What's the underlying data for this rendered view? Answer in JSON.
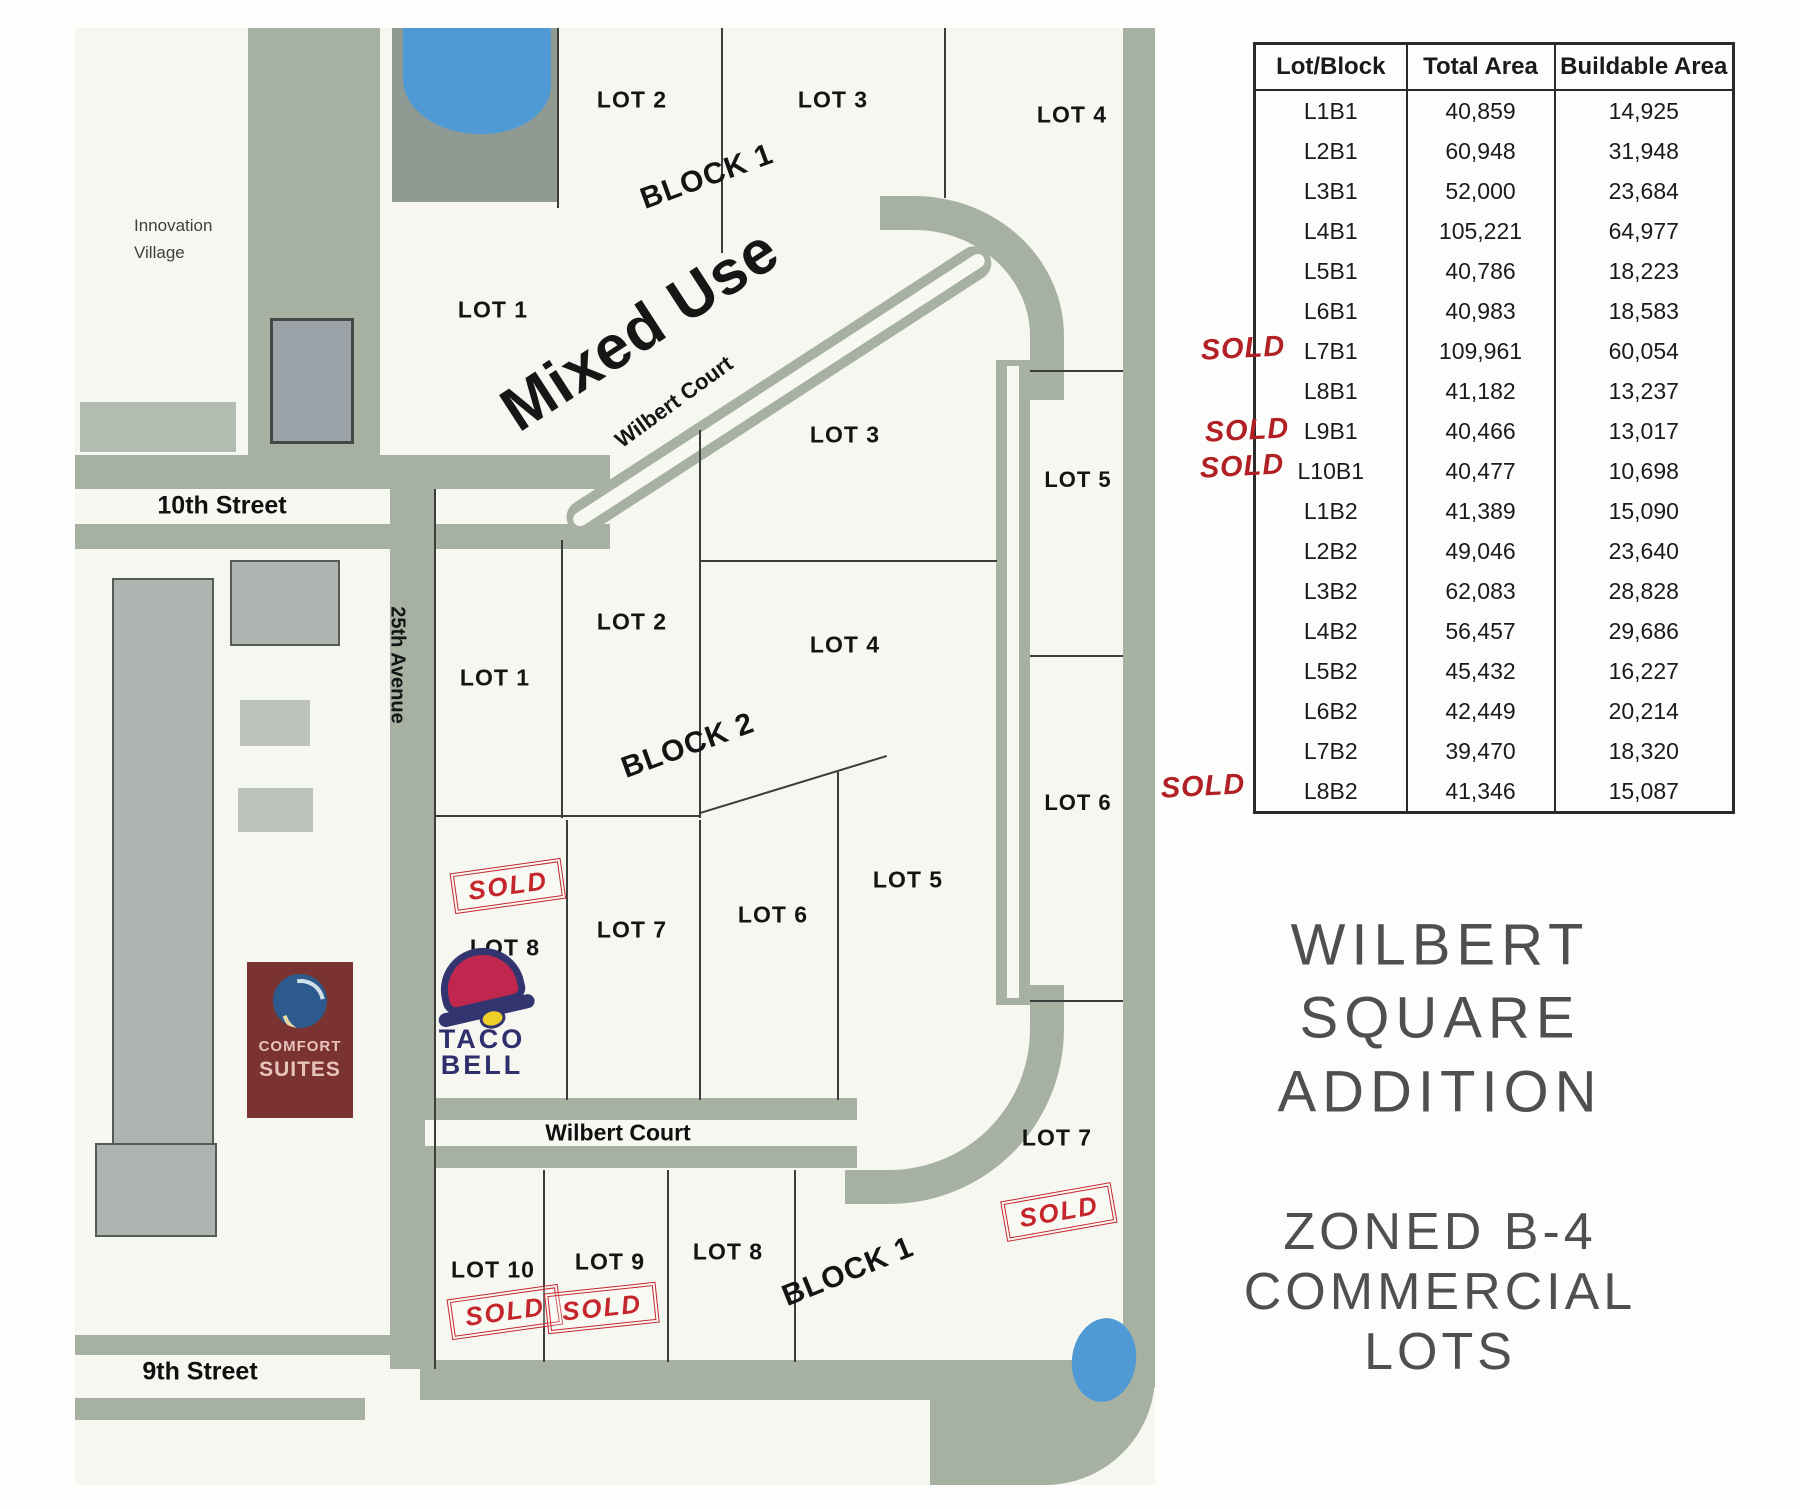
{
  "map": {
    "streets": {
      "tenth_street": "10th Street",
      "ninth_street": "9th Street",
      "avenue_25th": "25th Avenue",
      "wilbert_court_upper": "Wilbert Court",
      "wilbert_court_lower": "Wilbert Court"
    },
    "innovation_village_lines": [
      "Innovation",
      "Village"
    ],
    "mixed_use": "Mixed Use",
    "block_labels": {
      "block1_north": "BLOCK 1",
      "block2": "BLOCK 2",
      "block1_south": "BLOCK 1"
    },
    "lot_labels": {
      "b1t_lot1": "LOT 1",
      "b1t_lot2": "LOT 2",
      "b1t_lot3": "LOT 3",
      "b1t_lot4": "LOT 4",
      "b1r_lot5": "LOT 5",
      "b1r_lot6": "LOT 6",
      "b1r_lot7": "LOT 7",
      "b2_lot1": "LOT 1",
      "b2_lot2": "LOT 2",
      "b2_lot3": "LOT 3",
      "b2_lot4": "LOT 4",
      "b2_lot5": "LOT 5",
      "b2_lot6": "LOT 6",
      "b2_lot7": "LOT 7",
      "b2_lot8": "LOT 8",
      "b1b_lot8": "LOT 8",
      "b1b_lot9": "LOT 9",
      "b1b_lot10": "LOT 10"
    },
    "sold_label": "SOLD"
  },
  "logos": {
    "comfort_suites": {
      "line1": "COMFORT",
      "line2": "SUITES"
    },
    "taco_bell": {
      "line1": "TACO",
      "line2": "BELL"
    }
  },
  "table": {
    "headers": [
      "Lot/Block",
      "Total Area",
      "Buildable Area"
    ],
    "rows": [
      {
        "lot": "L1B1",
        "total": "40,859",
        "buildable": "14,925",
        "sold": false
      },
      {
        "lot": "L2B1",
        "total": "60,948",
        "buildable": "31,948",
        "sold": false
      },
      {
        "lot": "L3B1",
        "total": "52,000",
        "buildable": "23,684",
        "sold": false
      },
      {
        "lot": "L4B1",
        "total": "105,221",
        "buildable": "64,977",
        "sold": false
      },
      {
        "lot": "L5B1",
        "total": "40,786",
        "buildable": "18,223",
        "sold": false
      },
      {
        "lot": "L6B1",
        "total": "40,983",
        "buildable": "18,583",
        "sold": false
      },
      {
        "lot": "L7B1",
        "total": "109,961",
        "buildable": "60,054",
        "sold": true
      },
      {
        "lot": "L8B1",
        "total": "41,182",
        "buildable": "13,237",
        "sold": false
      },
      {
        "lot": "L9B1",
        "total": "40,466",
        "buildable": "13,017",
        "sold": true
      },
      {
        "lot": "L10B1",
        "total": "40,477",
        "buildable": "10,698",
        "sold": true
      },
      {
        "lot": "L1B2",
        "total": "41,389",
        "buildable": "15,090",
        "sold": false
      },
      {
        "lot": "L2B2",
        "total": "49,046",
        "buildable": "23,640",
        "sold": false
      },
      {
        "lot": "L3B2",
        "total": "62,083",
        "buildable": "28,828",
        "sold": false
      },
      {
        "lot": "L4B2",
        "total": "56,457",
        "buildable": "29,686",
        "sold": false
      },
      {
        "lot": "L5B2",
        "total": "45,432",
        "buildable": "16,227",
        "sold": false
      },
      {
        "lot": "L6B2",
        "total": "42,449",
        "buildable": "20,214",
        "sold": false
      },
      {
        "lot": "L7B2",
        "total": "39,470",
        "buildable": "18,320",
        "sold": false
      },
      {
        "lot": "L8B2",
        "total": "41,346",
        "buildable": "15,087",
        "sold": true
      }
    ]
  },
  "panel": {
    "title_lines": [
      "WILBERT",
      "SQUARE",
      "ADDITION"
    ],
    "zoning_lines": [
      "ZONED B-4",
      "COMMERCIAL",
      "LOTS"
    ]
  },
  "colors": {
    "road_sage": "#a7b1a2",
    "pond_blue": "#4f9ad4",
    "sold_red": "#c4262c",
    "title_gray": "#4f4f4f",
    "comfort_maroon": "#7a3331",
    "taco_navy": "#32356f"
  }
}
